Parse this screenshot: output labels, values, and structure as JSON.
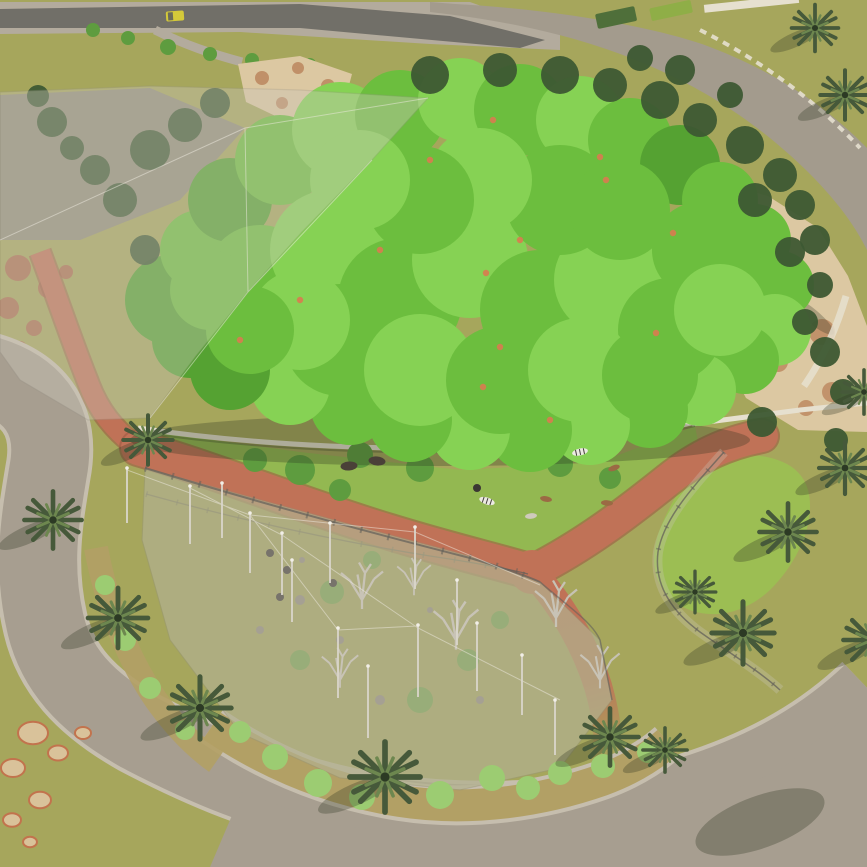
{
  "meta": {
    "title": "Zoo safari park aerial 3D render",
    "type": "architectural-visualization",
    "view": "aerial-oblique",
    "description": "Rendered aerial view of a zoo masterplan: large tree canopy habitat, two net-covered aviary enclosures, animal paddock with zebras and ostriches, branching terracotta visitor paths, palm-lined gray promenades and a service street with a yellow cart."
  },
  "scene": {
    "colors": {
      "lawn": "#a6a65c",
      "paddock_grass": "#93b851",
      "enclosed_lawn": "#9cbe53",
      "road": "#a39b8d",
      "street": "#716f68",
      "sidewalk": "#b3ab9d",
      "walkway": "#a79e90",
      "curb": "#c6beae",
      "red_path": "#c07257",
      "red_dark": "#9e5a43",
      "sand": "#dcc8a2",
      "rock": "#bd8a62",
      "rock_gray": "#8a8578",
      "red_rock": "#ad6a4e",
      "canopy_dark": "#55a232",
      "canopy_main": "#6cbe3e",
      "canopy_light": "#86d254",
      "conifer": "#3d5833",
      "palm": "#46593a",
      "palm_light": "#6d874f",
      "palm_dark": "#2c3a24",
      "mesh": "#cbc6ba",
      "mesh_dark": "#8d897e",
      "wall": "#e6e0cf",
      "gravel": "#b2a065",
      "shrub": "#9ccc72",
      "aviary_shrub": "#6f9c49",
      "pole": "#dad6cb",
      "bare_tree": "#c6c2b4",
      "shadow": "#2e3522",
      "zebra": "#eceae2",
      "ostrich": "#3b3733",
      "antelope": "#9b6a44",
      "pale_antelope": "#cfcabc",
      "bison": "#4a4038",
      "cart": "#d4c93a",
      "cart_cab": "#6b6b5a",
      "flower": "#d97b50",
      "fence": "#63605a",
      "paddock_tree": "#5e9c3f",
      "interior_tint": "#8e9150",
      "hedge_dark": "#4f6f3a",
      "hedge_light": "#8fae47"
    },
    "canopy_blobs": [
      [
        170,
        300,
        45,
        0
      ],
      [
        200,
        250,
        40,
        1
      ],
      [
        230,
        200,
        42,
        0
      ],
      [
        280,
        160,
        45,
        1
      ],
      [
        340,
        130,
        48,
        2
      ],
      [
        400,
        115,
        45,
        1
      ],
      [
        460,
        100,
        42,
        2
      ],
      [
        520,
        110,
        46,
        1
      ],
      [
        580,
        120,
        44,
        2
      ],
      [
        630,
        140,
        42,
        1
      ],
      [
        680,
        165,
        40,
        0
      ],
      [
        720,
        200,
        38,
        1
      ],
      [
        755,
        240,
        36,
        1
      ],
      [
        780,
        285,
        34,
        1
      ],
      [
        775,
        330,
        36,
        2
      ],
      [
        745,
        360,
        34,
        1
      ],
      [
        700,
        390,
        36,
        2
      ],
      [
        650,
        410,
        38,
        1
      ],
      [
        590,
        425,
        40,
        2
      ],
      [
        530,
        430,
        42,
        1
      ],
      [
        470,
        430,
        40,
        2
      ],
      [
        410,
        420,
        42,
        1
      ],
      [
        350,
        405,
        40,
        1
      ],
      [
        290,
        385,
        40,
        2
      ],
      [
        230,
        370,
        40,
        0
      ],
      [
        190,
        340,
        38,
        0
      ],
      [
        260,
        280,
        55,
        1
      ],
      [
        330,
        250,
        60,
        2
      ],
      [
        400,
        300,
        62,
        1
      ],
      [
        470,
        260,
        58,
        2
      ],
      [
        540,
        310,
        60,
        1
      ],
      [
        610,
        280,
        56,
        2
      ],
      [
        670,
        330,
        52,
        1
      ],
      [
        340,
        340,
        56,
        1
      ],
      [
        420,
        370,
        56,
        2
      ],
      [
        500,
        380,
        54,
        1
      ],
      [
        580,
        370,
        52,
        2
      ],
      [
        650,
        375,
        48,
        1
      ],
      [
        300,
        320,
        50,
        2
      ],
      [
        560,
        200,
        55,
        1
      ],
      [
        480,
        180,
        52,
        2
      ],
      [
        620,
        210,
        50,
        1
      ],
      [
        420,
        200,
        54,
        1
      ],
      [
        360,
        180,
        50,
        2
      ],
      [
        700,
        250,
        48,
        1
      ],
      [
        720,
        310,
        46,
        2
      ],
      [
        250,
        330,
        44,
        1
      ],
      [
        210,
        290,
        40,
        1
      ]
    ],
    "conifers": [
      [
        150,
        150,
        20
      ],
      [
        185,
        125,
        17
      ],
      [
        215,
        103,
        15
      ],
      [
        430,
        75,
        19
      ],
      [
        500,
        70,
        17
      ],
      [
        560,
        75,
        19
      ],
      [
        610,
        85,
        17
      ],
      [
        660,
        100,
        19
      ],
      [
        700,
        120,
        17
      ],
      [
        745,
        145,
        19
      ],
      [
        780,
        175,
        17
      ],
      [
        800,
        205,
        15
      ],
      [
        815,
        240,
        15
      ],
      [
        120,
        200,
        17
      ],
      [
        95,
        170,
        15
      ],
      [
        680,
        70,
        15
      ],
      [
        730,
        95,
        13
      ],
      [
        640,
        58,
        13
      ],
      [
        820,
        285,
        13
      ],
      [
        805,
        322,
        13
      ],
      [
        755,
        200,
        17
      ],
      [
        790,
        252,
        15
      ],
      [
        825,
        352,
        15
      ],
      [
        843,
        392,
        13
      ],
      [
        762,
        422,
        15
      ],
      [
        145,
        250,
        15
      ],
      [
        52,
        122,
        15
      ],
      [
        72,
        148,
        12
      ],
      [
        38,
        96,
        11
      ],
      [
        836,
        440,
        12
      ]
    ],
    "canopy_flowers": [
      [
        493,
        120
      ],
      [
        600,
        157
      ],
      [
        606,
        180
      ],
      [
        673,
        233
      ],
      [
        486,
        273
      ],
      [
        500,
        347
      ],
      [
        656,
        333
      ],
      [
        483,
        387
      ],
      [
        300,
        300
      ],
      [
        380,
        250
      ],
      [
        550,
        420
      ],
      [
        240,
        340
      ],
      [
        430,
        160
      ],
      [
        520,
        240
      ]
    ],
    "paddock_trees": [
      [
        300,
        470,
        15
      ],
      [
        360,
        455,
        13
      ],
      [
        420,
        468,
        14
      ],
      [
        470,
        450,
        12
      ],
      [
        560,
        464,
        13
      ],
      [
        610,
        478,
        11
      ],
      [
        340,
        490,
        11
      ],
      [
        255,
        460,
        12
      ]
    ],
    "street_bushes": [
      [
        93,
        30,
        7
      ],
      [
        128,
        38,
        7
      ],
      [
        168,
        47,
        8
      ],
      [
        210,
        54,
        7
      ],
      [
        252,
        60,
        7
      ],
      [
        310,
        64,
        6
      ]
    ],
    "shrubs": [
      [
        275,
        757,
        13
      ],
      [
        318,
        783,
        14
      ],
      [
        362,
        797,
        13
      ],
      [
        440,
        795,
        14
      ],
      [
        492,
        778,
        13
      ],
      [
        528,
        788,
        12
      ],
      [
        560,
        773,
        12
      ],
      [
        603,
        766,
        12
      ],
      [
        648,
        752,
        11
      ],
      [
        240,
        732,
        11
      ],
      [
        105,
        585,
        10
      ],
      [
        125,
        640,
        11
      ],
      [
        150,
        688,
        11
      ],
      [
        185,
        730,
        10
      ]
    ],
    "aviary_shrubs": [
      [
        332,
        592,
        12
      ],
      [
        420,
        700,
        13
      ],
      [
        468,
        660,
        11
      ],
      [
        372,
        560,
        9
      ],
      [
        300,
        660,
        10
      ],
      [
        500,
        620,
        9
      ]
    ],
    "aviary_rocks": [
      [
        300,
        600,
        5
      ],
      [
        340,
        640,
        4
      ],
      [
        260,
        630,
        4
      ],
      [
        380,
        700,
        5
      ],
      [
        302,
        560,
        3
      ],
      [
        480,
        700,
        4
      ],
      [
        430,
        610,
        3
      ]
    ],
    "bare_trees": [
      [
        362,
        600,
        1.5
      ],
      [
        456,
        640,
        1.6
      ],
      [
        556,
        618,
        1.5
      ],
      [
        600,
        680,
        1.4
      ],
      [
        414,
        588,
        1.2
      ],
      [
        340,
        680,
        1.3
      ]
    ],
    "net_poles": [
      [
        127,
        468,
        55
      ],
      [
        190,
        486,
        58
      ],
      [
        222,
        483,
        55
      ],
      [
        250,
        513,
        60
      ],
      [
        282,
        533,
        62
      ],
      [
        330,
        523,
        60
      ],
      [
        338,
        628,
        70
      ],
      [
        415,
        527,
        62
      ],
      [
        418,
        625,
        72
      ],
      [
        292,
        560,
        62
      ],
      [
        457,
        580,
        65
      ],
      [
        477,
        623,
        68
      ],
      [
        368,
        666,
        72
      ],
      [
        522,
        655,
        60
      ],
      [
        555,
        700,
        55
      ]
    ],
    "animals": [
      [
        580,
        452,
        "zebra",
        -12
      ],
      [
        487,
        501,
        "zebra",
        18
      ],
      [
        477,
        488,
        "ostrich",
        0
      ],
      [
        546,
        499,
        "antelope",
        10
      ],
      [
        531,
        516,
        "pale_antelope",
        -6
      ],
      [
        607,
        503,
        "antelope",
        4
      ],
      [
        614,
        468,
        "antelope",
        -20
      ],
      [
        377,
        461,
        "bison",
        6
      ],
      [
        349,
        466,
        "bison",
        -4
      ],
      [
        270,
        553,
        "ostrich",
        0
      ],
      [
        287,
        570,
        "ostrich",
        0
      ],
      [
        280,
        597,
        "ostrich",
        0
      ],
      [
        333,
        583,
        "ostrich",
        0
      ]
    ],
    "palms": [
      [
        53,
        520,
        1.1
      ],
      [
        118,
        618,
        1.15
      ],
      [
        200,
        708,
        1.2
      ],
      [
        385,
        777,
        1.35
      ],
      [
        610,
        737,
        1.1
      ],
      [
        665,
        750,
        0.85
      ],
      [
        743,
        633,
        1.2
      ],
      [
        788,
        532,
        1.1
      ],
      [
        845,
        468,
        1.0
      ],
      [
        148,
        440,
        0.95
      ],
      [
        695,
        592,
        0.8
      ],
      [
        815,
        28,
        0.9
      ],
      [
        845,
        95,
        0.95
      ],
      [
        872,
        640,
        1.1
      ],
      [
        864,
        392,
        0.85
      ]
    ],
    "lawn_motifs": [
      [
        33,
        733,
        15
      ],
      [
        13,
        768,
        12
      ],
      [
        58,
        753,
        10
      ],
      [
        83,
        733,
        8
      ],
      [
        40,
        800,
        11
      ],
      [
        12,
        820,
        9
      ],
      [
        30,
        842,
        7
      ]
    ],
    "sand_rocks_tl": [
      [
        262,
        78,
        7
      ],
      [
        298,
        68,
        6
      ],
      [
        328,
        86,
        7
      ],
      [
        282,
        103,
        6
      ],
      [
        312,
        100,
        5
      ]
    ],
    "sand_rocks_right": [
      [
        758,
        238,
        14
      ],
      [
        792,
        282,
        12
      ],
      [
        822,
        332,
        13
      ],
      [
        778,
        362,
        10
      ],
      [
        742,
        300,
        11
      ],
      [
        832,
        392,
        10
      ],
      [
        806,
        408,
        8
      ]
    ],
    "red_rocks": [
      [
        18,
        268,
        13
      ],
      [
        48,
        288,
        10
      ],
      [
        8,
        308,
        11
      ],
      [
        34,
        328,
        8
      ],
      [
        66,
        272,
        7
      ],
      [
        20,
        348,
        7
      ]
    ]
  }
}
